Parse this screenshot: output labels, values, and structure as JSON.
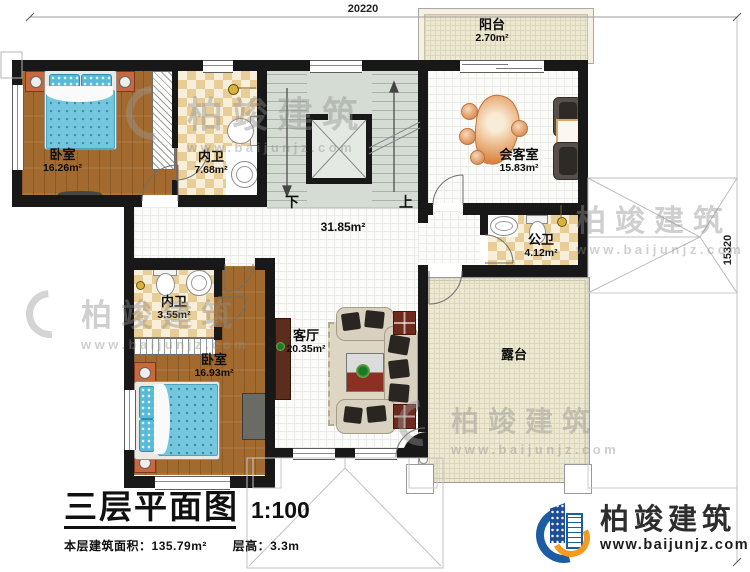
{
  "dimensions": {
    "top": "20220",
    "right": "15320"
  },
  "rooms": {
    "balcony": {
      "name": "阳台",
      "area": "2.70m²"
    },
    "bedroom1": {
      "name": "卧室",
      "area": "16.26m²"
    },
    "bath1": {
      "name": "内卫",
      "area": "7.68m²"
    },
    "reception": {
      "name": "会客室",
      "area": "15.83m²"
    },
    "hall": {
      "area": "31.85m²"
    },
    "public_bath": {
      "name": "公卫",
      "area": "4.12m²"
    },
    "bath2": {
      "name": "内卫",
      "area": "3.55m²"
    },
    "bedroom2": {
      "name": "卧室",
      "area": "16.93m²"
    },
    "living": {
      "name": "客厅",
      "area": "20.35m²"
    },
    "terrace": {
      "name": "露台"
    }
  },
  "stairs": {
    "down": "下",
    "up": "上"
  },
  "title": {
    "main": "三层平面图",
    "scale": "1:100",
    "area_label": "本层建筑面积：",
    "area_value": "135.79m²",
    "height_label": "层高：",
    "height_value": "3.3m"
  },
  "brand": {
    "name": "柏竣建筑",
    "url": "www.baijunjz.com"
  },
  "watermark": {
    "text": "柏竣建筑",
    "url": "www.baijunjz.com"
  },
  "colors": {
    "wall": "#181818",
    "wood": "#a26a2e",
    "tile_tan": "#e9cd97",
    "water_blue": "#74c6de",
    "plan_beige": "#ece8d2",
    "brand_blue": "#1b5ca3",
    "brand_orange": "#f29b1d"
  }
}
